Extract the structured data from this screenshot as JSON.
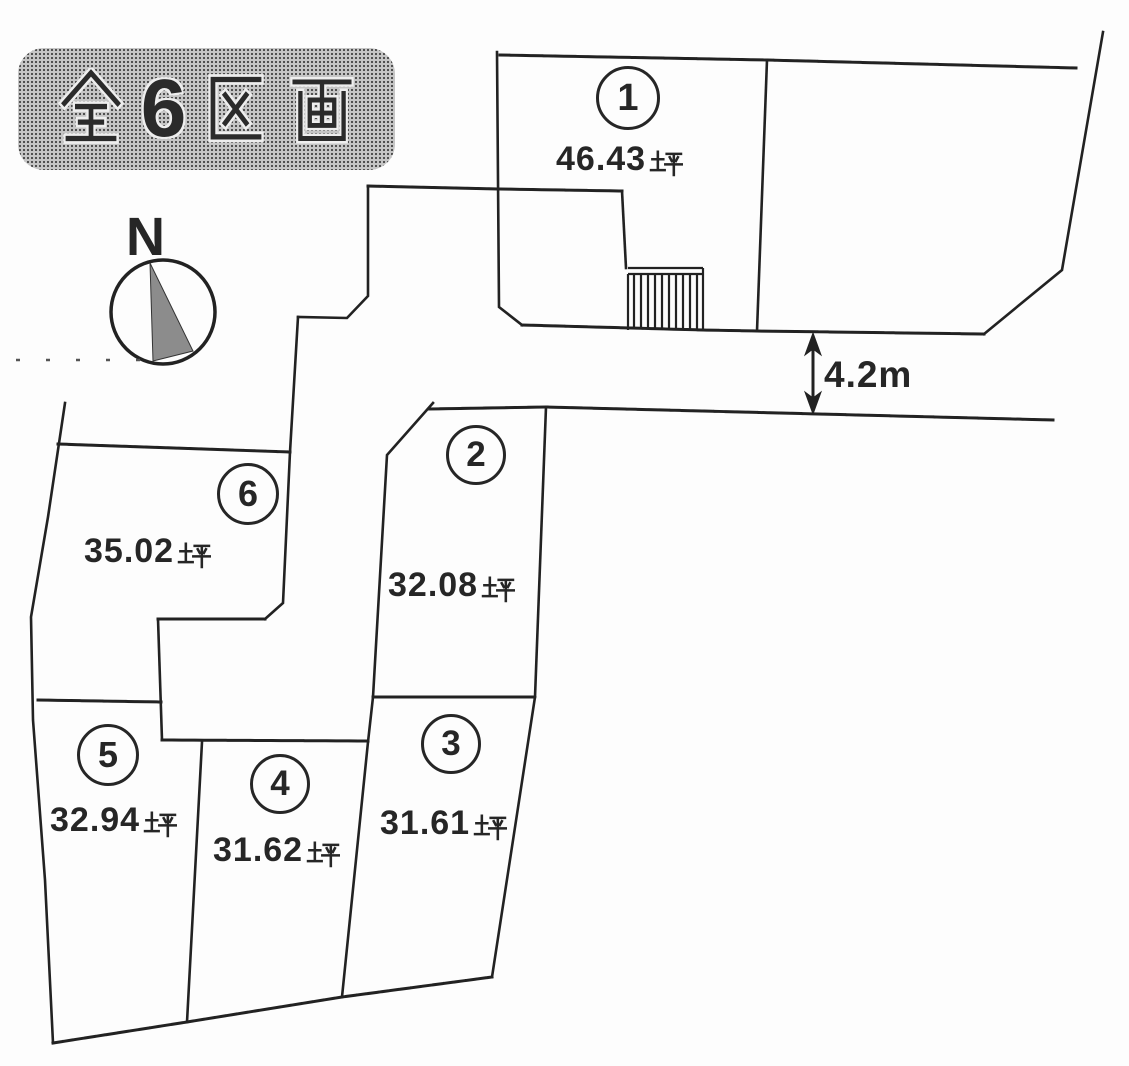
{
  "title": {
    "text": "全6区画",
    "digit": "6",
    "chars": [
      "全",
      "6",
      "区",
      "画"
    ]
  },
  "compass": {
    "label": "N"
  },
  "road": {
    "width_label": "4.2m"
  },
  "area_unit": "坪",
  "lots": [
    {
      "number": "1",
      "circled": "①",
      "area_value": "46.43",
      "area_label": "46.43坪"
    },
    {
      "number": "2",
      "circled": "②",
      "area_value": "32.08",
      "area_label": "32.08坪"
    },
    {
      "number": "3",
      "circled": "③",
      "area_value": "31.61",
      "area_label": "31.61坪"
    },
    {
      "number": "4",
      "circled": "④",
      "area_value": "31.62",
      "area_label": "31.62坪"
    },
    {
      "number": "5",
      "circled": "⑤",
      "area_value": "32.94",
      "area_label": "32.94坪"
    },
    {
      "number": "6",
      "circled": "⑥",
      "area_value": "35.02",
      "area_label": "35.02坪"
    }
  ],
  "colors": {
    "line": "#222222",
    "ink": "#262626",
    "halftone_bg": "#c6c6c6",
    "halftone_dot": "#4a4a4a",
    "needle_fill": "#8c8c8c"
  }
}
